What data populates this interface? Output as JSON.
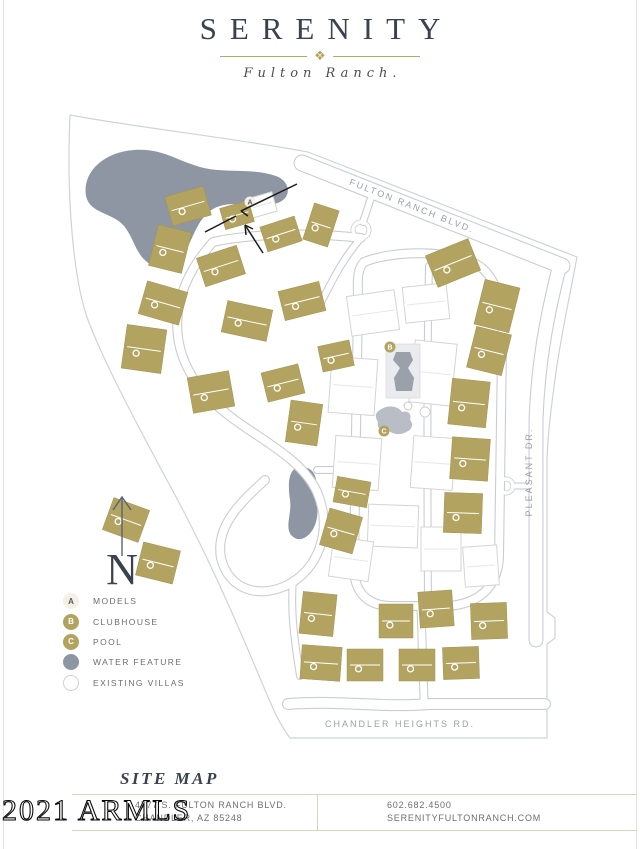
{
  "header": {
    "title": "SERENITY",
    "ornament_glyph": "❖",
    "subtitle": "Fulton Ranch."
  },
  "map": {
    "street_labels": {
      "fulton": "FULTON RANCH BLVD.",
      "pleasant": "PLEASANT DR.",
      "chandler": "CHANDLER HEIGHTS RD."
    },
    "north_label": "N",
    "markers": {
      "a": "A",
      "b": "B",
      "c": "C"
    }
  },
  "legend": {
    "items": [
      {
        "key": "A",
        "label": "MODELS",
        "style": "cream"
      },
      {
        "key": "B",
        "label": "CLUBHOUSE",
        "style": "gold"
      },
      {
        "key": "C",
        "label": "POOL",
        "style": "gold"
      },
      {
        "key": "",
        "label": "WATER FEATURE",
        "style": "water"
      },
      {
        "key": "",
        "label": "EXISTING VILLAS",
        "style": "outline"
      }
    ]
  },
  "footer": {
    "section_title": "SITE MAP",
    "address_line1": "4777 S. FULTON RANCH BLVD.",
    "address_line2": "CHANDLER, AZ 85248",
    "phone": "602.682.4500",
    "website": "SERENITYFULTONRANCH.COM"
  },
  "watermark": "2021 ARMLS",
  "colors": {
    "brand_ink": "#39424e",
    "gold": "#b3a361",
    "water": "#8e96a4",
    "road": "#c9cdd3",
    "footer_line": "#d7d3bd",
    "text_gray": "#6e6e6e"
  }
}
